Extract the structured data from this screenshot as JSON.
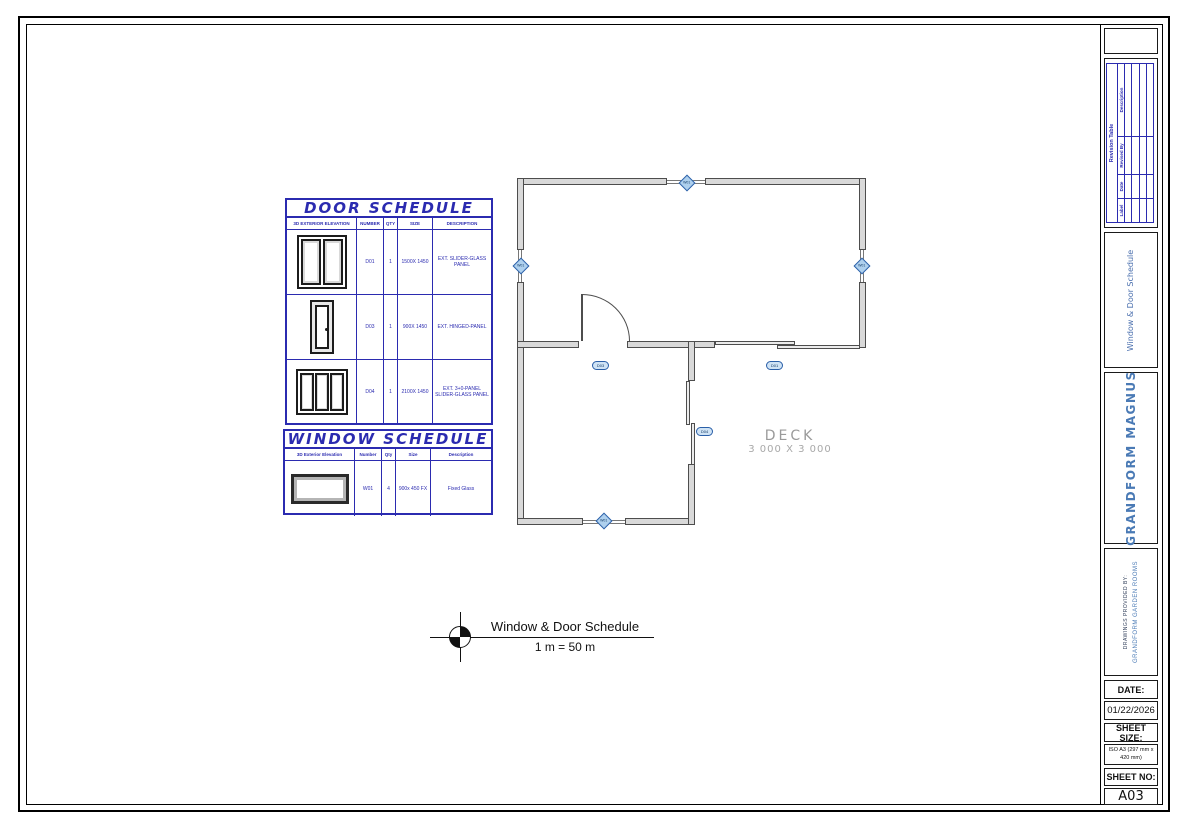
{
  "colors": {
    "schedule_blue": "#2b2bb0",
    "titleblock_blue": "#4a7ab5",
    "marker_fill": "#aed0ee",
    "marker_border": "#2a5fa8",
    "deck_gray": "#9a9a9a"
  },
  "door_schedule": {
    "title": "DOOR SCHEDULE",
    "headers": [
      "3D EXTERIOR ELEVATION",
      "NUMBER",
      "QTY",
      "SIZE",
      "DESCRIPTION"
    ],
    "rows": [
      {
        "thumb_icon": "door-2-panel-slider",
        "number": "D01",
        "qty": "1",
        "size": "1500X 1450",
        "description": "EXT. SLIDER-GLASS PANEL"
      },
      {
        "thumb_icon": "door-single-hinged",
        "number": "D03",
        "qty": "1",
        "size": "900X 1450",
        "description": "EXT. HINGED-PANEL"
      },
      {
        "thumb_icon": "door-3-panel-slider",
        "number": "D04",
        "qty": "1",
        "size": "2100X 1450",
        "description": "EXT. 3+0-PANEL SLIDER-GLASS PANEL"
      }
    ]
  },
  "window_schedule": {
    "title": "WINDOW SCHEDULE",
    "headers": [
      "3D Exterior Elevation",
      "Number",
      "Qty",
      "Size",
      "Description"
    ],
    "rows": [
      {
        "thumb_icon": "window-fixed",
        "number": "W01",
        "qty": "4",
        "size": "900x 450 FX",
        "description": "Fixed Glass"
      }
    ]
  },
  "floorplan": {
    "deck_label": "DECK",
    "deck_size": "3 000 X 3 000",
    "markers": {
      "window_tag": "W01",
      "door_tag_1": "D03",
      "door_tag_2": "D01",
      "door_tag_3": "D04"
    }
  },
  "drawing_title": {
    "symbol_icon": "datum-quadrant-circle",
    "title": "Window & Door Schedule",
    "scale": "1 m = 50 m"
  },
  "titleblock": {
    "revision_table": {
      "title": "Revision Table",
      "headers": [
        "Label",
        "Date",
        "Revised By",
        "Description"
      ]
    },
    "sheet_label": "Window & Door Schedule",
    "company": "GRANDFORM MAGNUS",
    "provided_by_label": "DRAWINGS PROVIDED BY:",
    "provided_by": "GRANDFORM GARDEN ROOMS",
    "date_label": "DATE:",
    "date_value": "01/22/2026",
    "sheet_size_label": "SHEET SIZE:",
    "sheet_size_value": "ISO A3  (297 mm x 420 mm)",
    "sheet_no_label": "SHEET NO:",
    "sheet_no_value": "A03"
  }
}
